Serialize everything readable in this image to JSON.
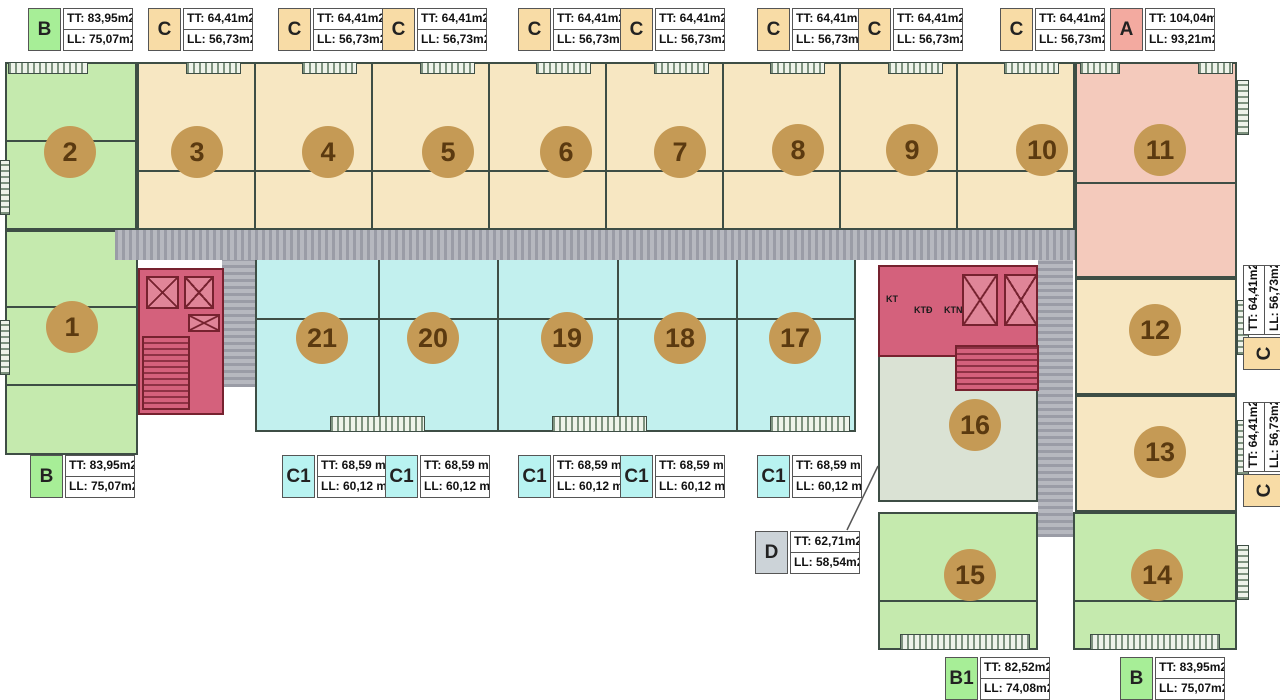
{
  "palette": {
    "unit_green": "#c5eaae",
    "unit_tan": "#f7e7c2",
    "unit_pink": "#f4cabc",
    "unit_cyan": "#c2f0ee",
    "unit_sage": "#dae2d4",
    "core_red": "#d4617c",
    "corridor_gray": "#a4a6ae",
    "circle_gold": "#c59a55",
    "circle_text": "#5b3a10",
    "badges": {
      "B": "#a7ee97",
      "B1": "#a7ee97",
      "C": "#f8dca6",
      "C1": "#b8f3f1",
      "A": "#f3aaa0",
      "D": "#ccd3d8"
    }
  },
  "circles": [
    {
      "n": "1",
      "x": 72,
      "y": 327
    },
    {
      "n": "2",
      "x": 70,
      "y": 152
    },
    {
      "n": "3",
      "x": 197,
      "y": 152
    },
    {
      "n": "4",
      "x": 328,
      "y": 152
    },
    {
      "n": "5",
      "x": 448,
      "y": 152
    },
    {
      "n": "6",
      "x": 566,
      "y": 152
    },
    {
      "n": "7",
      "x": 680,
      "y": 152
    },
    {
      "n": "8",
      "x": 798,
      "y": 150
    },
    {
      "n": "9",
      "x": 912,
      "y": 150
    },
    {
      "n": "10",
      "x": 1042,
      "y": 150
    },
    {
      "n": "11",
      "x": 1160,
      "y": 150
    },
    {
      "n": "12",
      "x": 1155,
      "y": 330
    },
    {
      "n": "13",
      "x": 1160,
      "y": 452
    },
    {
      "n": "14",
      "x": 1157,
      "y": 575
    },
    {
      "n": "15",
      "x": 970,
      "y": 575
    },
    {
      "n": "16",
      "x": 975,
      "y": 425
    },
    {
      "n": "17",
      "x": 795,
      "y": 338
    },
    {
      "n": "18",
      "x": 680,
      "y": 338
    },
    {
      "n": "19",
      "x": 567,
      "y": 338
    },
    {
      "n": "20",
      "x": 433,
      "y": 338
    },
    {
      "n": "21",
      "x": 322,
      "y": 338
    }
  ],
  "core_texts": [
    {
      "t": "KT",
      "x": 886,
      "y": 294
    },
    {
      "t": "KTĐ",
      "x": 914,
      "y": 305
    },
    {
      "t": "KTN",
      "x": 944,
      "y": 305
    }
  ],
  "area_labels": [
    {
      "badge": "B",
      "tt": "TT: 83,95m2",
      "ll": "LL: 75,07m2",
      "x": 28,
      "y": 8,
      "rot": false
    },
    {
      "badge": "C",
      "tt": "TT: 64,41m2",
      "ll": "LL: 56,73m2",
      "x": 148,
      "y": 8,
      "rot": false
    },
    {
      "badge": "C",
      "tt": "TT: 64,41m2",
      "ll": "LL: 56,73m2",
      "x": 278,
      "y": 8,
      "rot": false
    },
    {
      "badge": "C",
      "tt": "TT: 64,41m2",
      "ll": "LL: 56,73m2",
      "x": 382,
      "y": 8,
      "rot": false
    },
    {
      "badge": "C",
      "tt": "TT: 64,41m2",
      "ll": "LL: 56,73m2",
      "x": 518,
      "y": 8,
      "rot": false
    },
    {
      "badge": "C",
      "tt": "TT: 64,41m2",
      "ll": "LL: 56,73m2",
      "x": 620,
      "y": 8,
      "rot": false
    },
    {
      "badge": "C",
      "tt": "TT: 64,41m2",
      "ll": "LL: 56,73m2",
      "x": 757,
      "y": 8,
      "rot": false
    },
    {
      "badge": "C",
      "tt": "TT: 64,41m2",
      "ll": "LL: 56,73m2",
      "x": 858,
      "y": 8,
      "rot": false
    },
    {
      "badge": "C",
      "tt": "TT: 64,41m2",
      "ll": "LL: 56,73m2",
      "x": 1000,
      "y": 8,
      "rot": false
    },
    {
      "badge": "A",
      "tt": "TT: 104,04m2",
      "ll": "LL: 93,21m2",
      "x": 1110,
      "y": 8,
      "rot": false
    },
    {
      "badge": "B",
      "tt": "TT: 83,95m2",
      "ll": "LL: 75,07m2",
      "x": 30,
      "y": 455,
      "rot": false
    },
    {
      "badge": "C1",
      "tt": "TT: 68,59 m2",
      "ll": "LL: 60,12 m2",
      "x": 282,
      "y": 455,
      "rot": false
    },
    {
      "badge": "C1",
      "tt": "TT: 68,59 m2",
      "ll": "LL: 60,12 m2",
      "x": 385,
      "y": 455,
      "rot": false
    },
    {
      "badge": "C1",
      "tt": "TT: 68,59 m2",
      "ll": "LL: 60,12 m2",
      "x": 518,
      "y": 455,
      "rot": false
    },
    {
      "badge": "C1",
      "tt": "TT: 68,59 m2",
      "ll": "LL: 60,12 m2",
      "x": 620,
      "y": 455,
      "rot": false
    },
    {
      "badge": "C1",
      "tt": "TT: 68,59 m2",
      "ll": "LL: 60,12 m2",
      "x": 757,
      "y": 455,
      "rot": false
    },
    {
      "badge": "D",
      "tt": "TT: 62,71m2",
      "ll": "LL: 58,54m2",
      "x": 755,
      "y": 531,
      "rot": false
    },
    {
      "badge": "C",
      "tt": "TT: 64,41m2",
      "ll": "LL: 56,73m2",
      "x": 1243,
      "y": 370,
      "rot": true
    },
    {
      "badge": "C",
      "tt": "TT: 64,41m2",
      "ll": "LL: 56,73m2",
      "x": 1243,
      "y": 507,
      "rot": true
    },
    {
      "badge": "B1",
      "tt": "TT: 82,52m2",
      "ll": "LL: 74,08m2",
      "x": 945,
      "y": 657,
      "rot": false
    },
    {
      "badge": "B",
      "tt": "TT: 83,95m2",
      "ll": "LL: 75,07m2",
      "x": 1120,
      "y": 657,
      "rot": false
    }
  ]
}
